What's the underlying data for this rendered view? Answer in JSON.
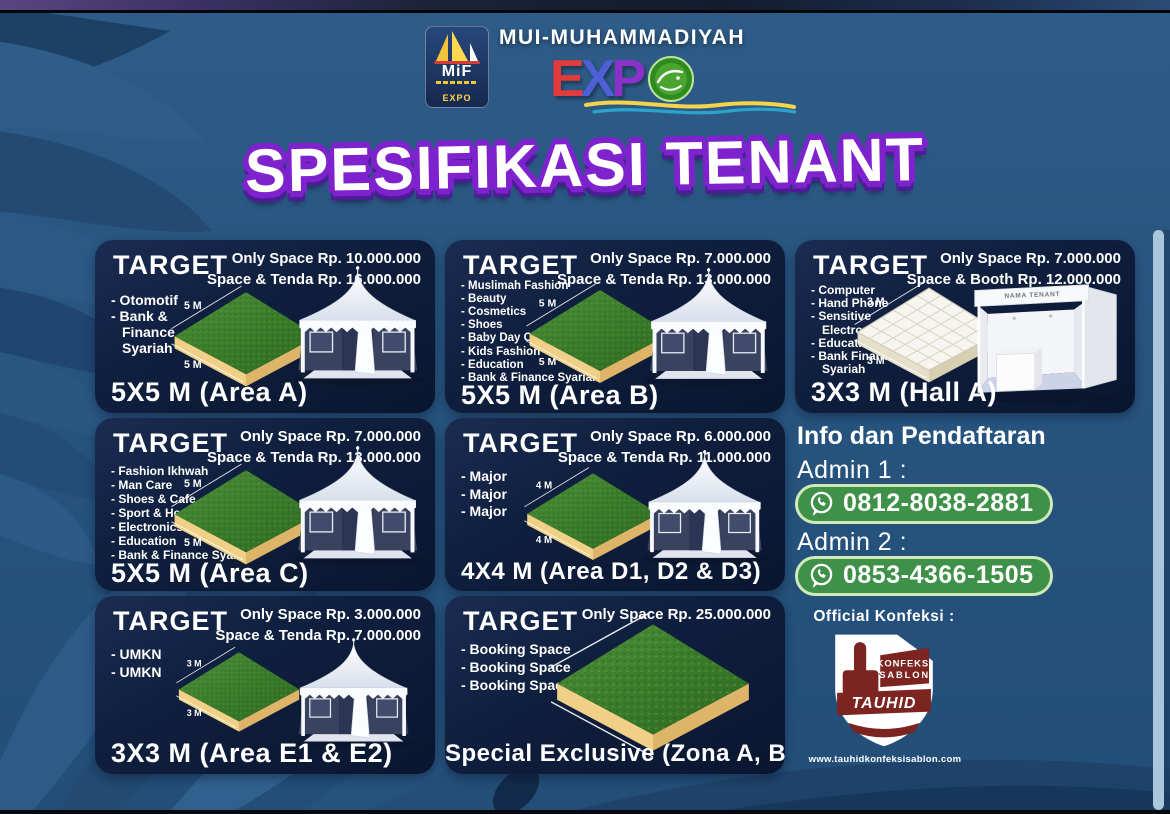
{
  "header": {
    "badge": {
      "label": "MiF",
      "expo": "EXPO"
    },
    "brand": "MUI-MUHAMMADIYAH",
    "expo_letters": {
      "e": "E",
      "x": "X",
      "p": "P"
    }
  },
  "title": "SPESIFIKASI TENANT",
  "cards": [
    {
      "target_label": "TARGET",
      "items": [
        "- Otomotif",
        "- Bank & Finance Syariah"
      ],
      "price_line1": "Only Space Rp. 10.000.000",
      "price_line2": "Space & Tenda Rp. 16.000.000",
      "dim_top": "5 M",
      "dim_bottom": "5 M",
      "size_label": "5X5 M (Area A)",
      "platform": "grass",
      "illustration": "tent"
    },
    {
      "target_label": "TARGET",
      "items": [
        "- Muslimah Fashion",
        "- Beauty",
        "- Cosmetics",
        "- Shoes",
        "- Baby Day Care",
        "- Kids Fashion",
        "- Education",
        "- Bank & Finance Syariah"
      ],
      "price_line1": "Only Space Rp. 7.000.000",
      "price_line2": "Space & Tenda Rp. 13.000.000",
      "dim_top": "5 M",
      "dim_bottom": "5 M",
      "size_label": "5X5 M (Area B)",
      "platform": "grass",
      "illustration": "tent"
    },
    {
      "target_label": "TARGET",
      "items": [
        "- Computer",
        "- Hand Phone",
        "- Sensitive Electronic",
        "- Education",
        "- Bank Finance Syariah"
      ],
      "price_line1": "Only Space Rp. 7.000.000",
      "price_line2": "Space & Booth Rp. 12.000.000",
      "dim_top": "3 M",
      "dim_bottom": "3 M",
      "size_label": "3X3 M (Hall A)",
      "platform": "tile",
      "illustration": "booth",
      "booth_sign": "NAMA TENANT"
    },
    {
      "target_label": "TARGET",
      "items": [
        "- Fashion Ikhwah",
        "- Man Care",
        "- Shoes & Cafe",
        "- Sport & Health",
        "- Electronics",
        "- Education",
        "- Bank & Finance Syariah"
      ],
      "price_line1": "Only Space Rp. 7.000.000",
      "price_line2": "Space & Tenda Rp. 13.000.000",
      "dim_top": "5 M",
      "dim_bottom": "5 M",
      "size_label": "5X5 M (Area C)",
      "platform": "grass",
      "illustration": "tent"
    },
    {
      "target_label": "TARGET",
      "items": [
        "- Major",
        "- Major",
        "- Major"
      ],
      "price_line1": "Only Space Rp. 6.000.000",
      "price_line2": "Space & Tenda Rp. 11.000.000",
      "dim_top": "4 M",
      "dim_bottom": "4 M",
      "size_label": "4X4 M (Area D1, D2 & D3)",
      "platform": "grass",
      "illustration": "tent"
    },
    {
      "target_label": "TARGET",
      "items": [
        "- UMKN",
        "- UMKN"
      ],
      "price_line1": "Only Space Rp. 3.000.000",
      "price_line2": "Space & Tenda Rp. 7.000.000",
      "dim_top": "3 M",
      "dim_bottom": "3 M",
      "size_label": "3X3 M (Area E1 & E2)",
      "platform": "grass",
      "illustration": "tent"
    },
    {
      "target_label": "TARGET",
      "items": [
        "- Booking Space",
        "- Booking Space",
        "- Booking Space"
      ],
      "price_line1": "Only Space Rp. 25.000.000",
      "price_line2": "",
      "size_label": "Special Exclusive (Zona A, B & C)",
      "platform": "grass-xl",
      "illustration": ""
    }
  ],
  "info": {
    "heading": "Info dan Pendaftaran",
    "admins": [
      {
        "label": "Admin 1 :",
        "phone": "0812-8038-2881"
      },
      {
        "label": "Admin 2 :",
        "phone": "0853-4366-1505"
      }
    ]
  },
  "konfeksi": {
    "heading": "Official Konfeksi :",
    "logo_top": "KONFEKSI",
    "logo_mid": "SABLON",
    "logo_name": "TAUHID",
    "url": "www.tauhidkonfeksisablon.com"
  },
  "colors": {
    "poster_bg": "#27547f",
    "card_bg": "#0f1f3e",
    "title_outline": "#7e22ce",
    "whatsapp_green": "#3f9149",
    "platform_grass": "#3a7c2b",
    "platform_base": "#ecc97f"
  }
}
